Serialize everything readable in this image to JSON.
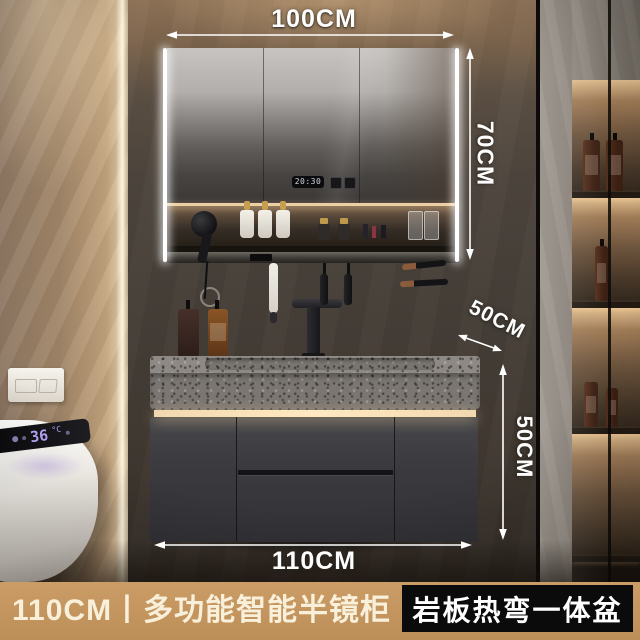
{
  "dimensions": {
    "mirror_width": "100CM",
    "mirror_height": "70CM",
    "counter_depth": "50CM",
    "cabinet_height": "50CM",
    "vanity_width": "110CM"
  },
  "mirror_display": {
    "time": "20:30"
  },
  "toilet_display": {
    "temperature": "36",
    "unit": "°C"
  },
  "caption_bar": {
    "product_title": "110CM丨多功能智能半镜柜",
    "feature_badge": "岩板热弯一体盆"
  },
  "colors": {
    "caption_background": "#c49660",
    "caption_text": "#f8f0da",
    "badge_background": "#0b0b0b",
    "badge_text": "#ffffff",
    "annotation_text": "#ffffff",
    "led_warm": "#ffe9c2",
    "toilet_led": "#b6a4f4",
    "cabinet_dark": "#3c3c40"
  },
  "icons": {
    "mirror_buttons": [
      "defog-button-icon",
      "light-button-icon"
    ],
    "toilet_icons": [
      "seat-heat-icon",
      "spray-icon",
      "night-light-icon"
    ]
  }
}
